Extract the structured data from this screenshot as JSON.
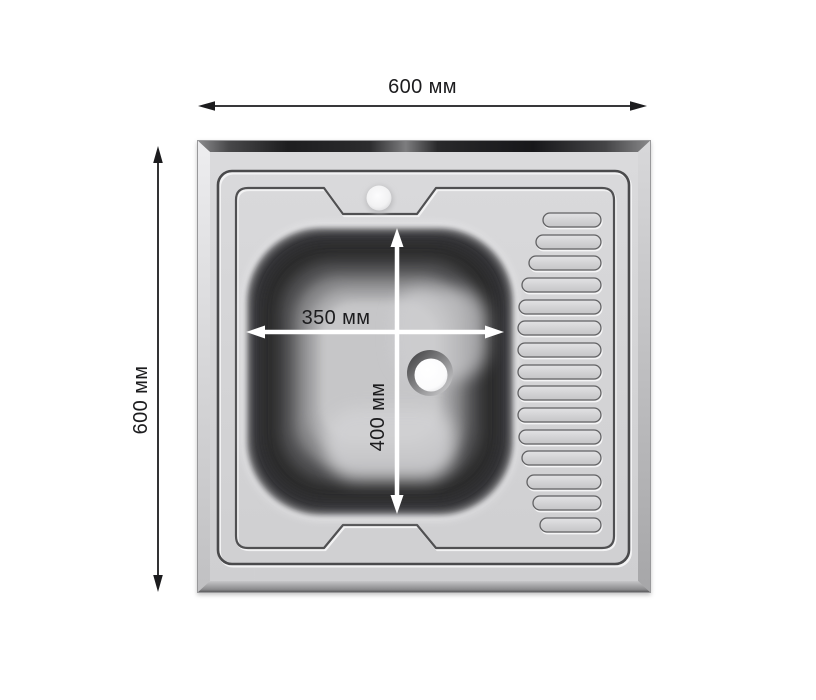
{
  "diagram": {
    "kind": "sink-dimension-drawing",
    "view": "top",
    "colors": {
      "background": "#ffffff",
      "outer_dimension_lines": "#1c1c1e",
      "inner_dimension_lines": "#ffffff",
      "steel_body": "#d4d4d6",
      "steel_edge_dark": "#1c1c1e"
    }
  },
  "dimensions": {
    "overall_width": {
      "label": "600 мм",
      "orientation": "horizontal",
      "position": "top"
    },
    "overall_height": {
      "label": "600 мм",
      "orientation": "vertical",
      "position": "left"
    },
    "bowl_width": {
      "label": "350 мм",
      "orientation": "horizontal",
      "position": "inside-bowl"
    },
    "bowl_depth": {
      "label": "400 мм",
      "orientation": "vertical",
      "position": "inside-bowl"
    }
  }
}
